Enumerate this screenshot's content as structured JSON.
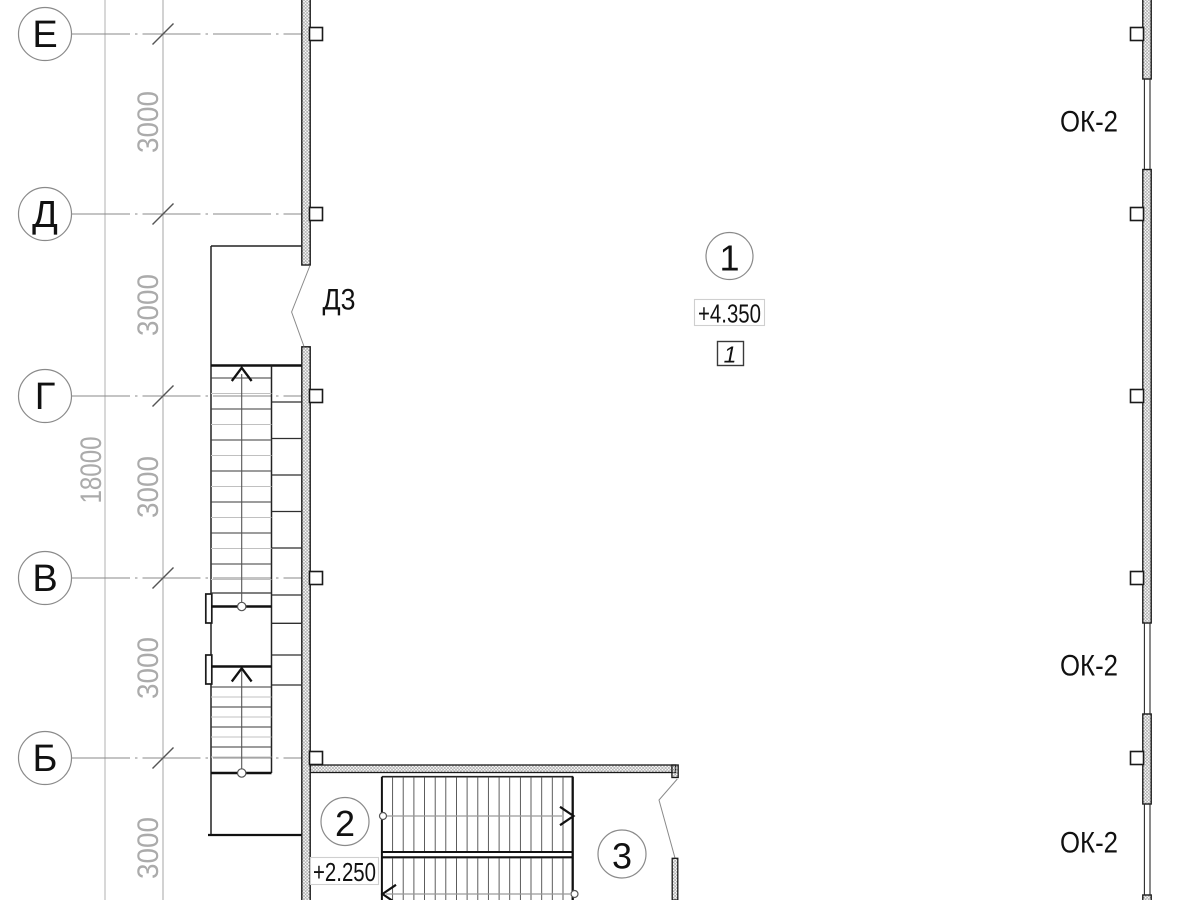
{
  "axis_labels": [
    "Е",
    "Д",
    "Г",
    "В",
    "Б"
  ],
  "dim_segments": [
    "3000",
    "3000",
    "3000",
    "3000",
    "3000"
  ],
  "dim_overall": "18000",
  "door_label": "Д3",
  "window_labels": [
    "ОК-2",
    "ОК-2",
    "ОК-2"
  ],
  "level_upper": "+4.350",
  "level_lower": "+2.250",
  "marker_1": "1",
  "marker_2": "2",
  "marker_3": "3",
  "detail_ref": "1",
  "colors": {
    "line": "#1a1a1a",
    "dim_gray": "#9a9a9a",
    "hatch_stroke": "#8f8f8f",
    "level_box_border": "#cfcfcf"
  }
}
